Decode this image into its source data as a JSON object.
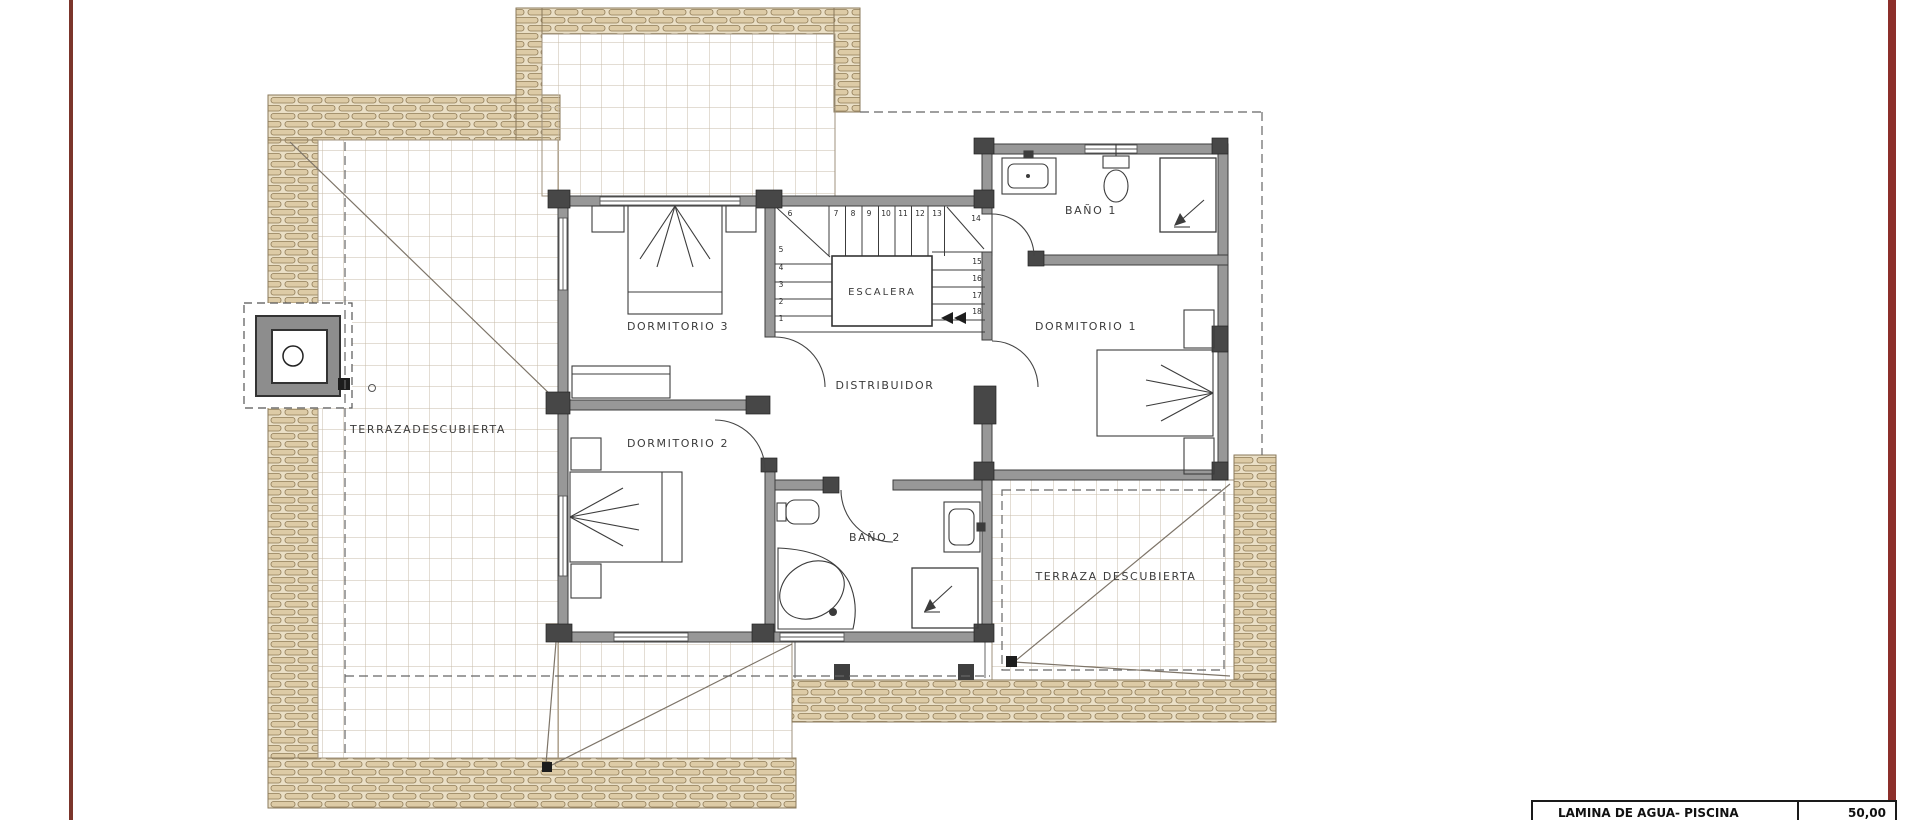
{
  "labels": {
    "terraza_left": "TERRAZADESCUBIERTA",
    "terraza_right": "TERRAZA DESCUBIERTA",
    "dormitorio1": "DORMITORIO 1",
    "dormitorio2": "DORMITORIO 2",
    "dormitorio3": "DORMITORIO 3",
    "bano1": "BAÑO 1",
    "bano2": "BAÑO 2",
    "escalera": "ESCALERA",
    "distribuidor": "DISTRIBUIDOR"
  },
  "stairs": {
    "numbers": [
      "1",
      "2",
      "3",
      "4",
      "5",
      "6",
      "7",
      "8",
      "9",
      "10",
      "11",
      "12",
      "13",
      "14",
      "15",
      "16",
      "17",
      "18"
    ]
  },
  "legend_table": {
    "rows": [
      {
        "label": "LAMINA DE AGUA- PISCINA",
        "value": "50,00"
      }
    ]
  },
  "icons": {
    "shower_arrows": "arrow-down-left",
    "stair_arrow": "double-triangle-left",
    "roof_point_marker": "black-square"
  },
  "colors": {
    "margin_line_left": "#7b352b",
    "margin_line_right": "#8c2f2a",
    "wall_gray": "#989898",
    "column_gray": "#474747",
    "tile_band_fill": "#eadfc6",
    "tile_band_brick": "#ddcba6",
    "grid_line": "#c7bba9",
    "ink": "#3b3b3b"
  }
}
